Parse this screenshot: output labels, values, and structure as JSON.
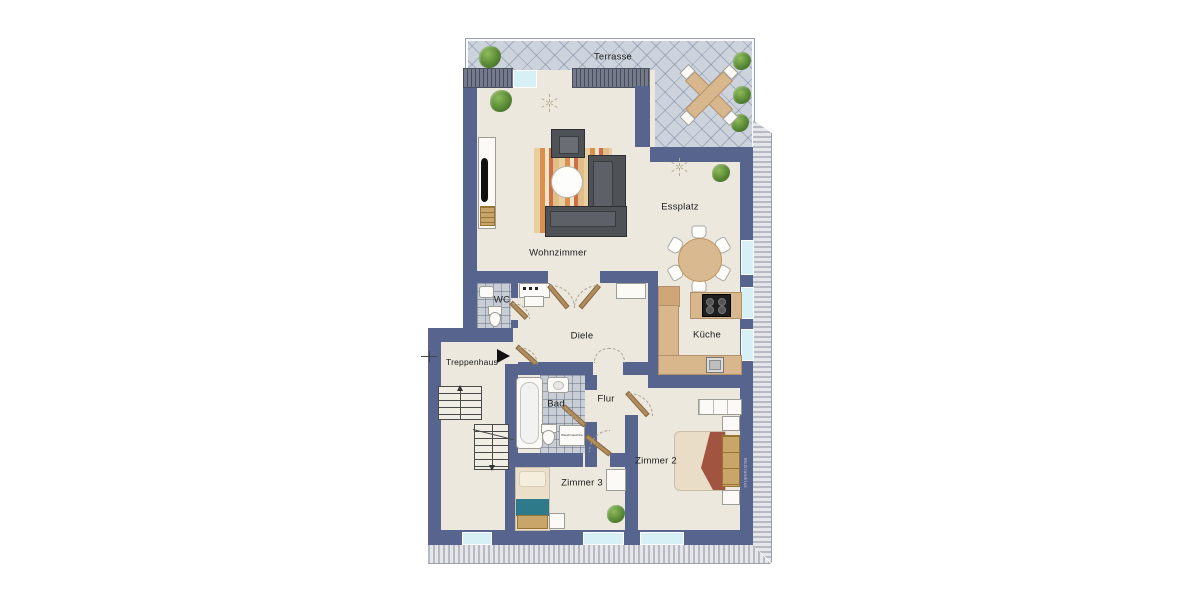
{
  "rooms": {
    "terrasse": {
      "label": "Terrasse"
    },
    "wohnzimmer": {
      "label": "Wohnzimmer"
    },
    "essplatz": {
      "label": "Essplatz"
    },
    "wc": {
      "label": "WC"
    },
    "diele": {
      "label": "Diele"
    },
    "kueche": {
      "label": "Küche"
    },
    "treppenhaus": {
      "label": "Treppenhaus"
    },
    "bad": {
      "label": "Bad"
    },
    "flur": {
      "label": "Flur"
    },
    "zimmer2": {
      "label": "Zimmer 2"
    },
    "zimmer3": {
      "label": "Zimmer 3"
    }
  },
  "appliances": {
    "washing_machine": "Waschmaschine"
  },
  "watermark": "McGrundriss",
  "colors": {
    "wall": "#57648e",
    "floor": "#ece8dd",
    "terrace_tile": "#ccd3dd",
    "counter": "#d9b78d",
    "window": "#d6f0f5",
    "wood": "#c8a568",
    "accent_teal": "#2f7a8a",
    "blanket_red": "#a1543f"
  }
}
